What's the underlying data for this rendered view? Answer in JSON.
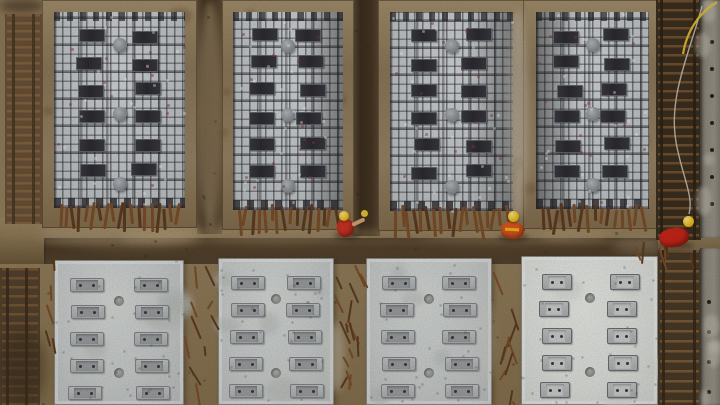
{
  "meta": {
    "description": "Aerial drone view of a precast concrete construction yard: four rebar formwork casting beds on top, four finished grey concrete slabs with embed plates below, rusty rebar ladders at the edges, and three workers wearing red/orange clothing and yellow hard hats standing in the trenches.",
    "width": 720,
    "height": 405
  },
  "palette": {
    "soil": "#97825f",
    "soil_dark": "#5e4a31",
    "soil_light": "#b6a083",
    "trench": "#3f3020",
    "frame": "#a08a68",
    "frame_rust": "#7a5737",
    "mat": "#c7ccce",
    "mat_grid": "#232328",
    "chair_plate": "#34333a",
    "slab": "#ccd0ce",
    "slab_bright": "#e4e6e2",
    "slab_plate": "#b9bcbd",
    "steel_dot": "#3a3a3a",
    "rust": "#7d4f2a",
    "rust_dark": "#5f3c22",
    "worker_red": "#cf3322",
    "worker_orange": "#e2561f",
    "hat_yellow": "#f2c41c",
    "skin": "#d8a478",
    "cable_pale": "#d6cfc0",
    "cable_yellow": "#e8c533",
    "wall": "#938d82"
  },
  "scene": {
    "mid_band": {
      "x": 0,
      "y": 218,
      "w": 720,
      "h": 46,
      "trench_x": 44,
      "trench_w": 614,
      "trench_y": 238,
      "trench_h": 26
    },
    "panels": [
      {
        "x": 42,
        "y": 0,
        "w": 155,
        "h": 228,
        "frame": 12,
        "dark_side": "none"
      },
      {
        "x": 222,
        "y": 0,
        "w": 132,
        "h": 230,
        "frame": 11,
        "dark_side": "right"
      },
      {
        "x": 378,
        "y": 0,
        "w": 147,
        "h": 231,
        "frame": 12,
        "dark_side": "right"
      },
      {
        "x": 523,
        "y": 0,
        "w": 139,
        "h": 229,
        "frame": 13,
        "dark_side": "left"
      }
    ],
    "panel_style": {
      "mat_top": 12,
      "mat_bottom": 20,
      "plate_w": 26,
      "plate_h": 13,
      "row_start": 18,
      "row_step": 27,
      "col_fracs": [
        0.28,
        0.7
      ],
      "circle_fracs": [
        0.17,
        0.52,
        0.88
      ],
      "circle_r": 7
    },
    "trenches": [
      {
        "x": 352,
        "y": 0,
        "w": 28,
        "h": 236
      },
      {
        "x": 197,
        "y": 0,
        "w": 25,
        "h": 234
      }
    ],
    "slabs": [
      {
        "x": 54,
        "y": 260,
        "w": 130,
        "h": 145,
        "bright": false
      },
      {
        "x": 218,
        "y": 258,
        "w": 116,
        "h": 147,
        "bright": false
      },
      {
        "x": 366,
        "y": 258,
        "w": 126,
        "h": 147,
        "bright": false
      },
      {
        "x": 521,
        "y": 256,
        "w": 137,
        "h": 149,
        "bright": true
      }
    ],
    "slab_style": {
      "plate_w": 34,
      "plate_h": 14,
      "bright_plate_w": 30,
      "bright_plate_h": 16,
      "row_start": 18,
      "row_step": 27,
      "rows": 5,
      "col_fracs": [
        0.25,
        0.75
      ],
      "hole_fracs": [
        0.28,
        0.78
      ],
      "hole_r": 5
    },
    "ladders": [
      {
        "name": "ladder-top-left",
        "x": 5,
        "y": 14,
        "w": 37,
        "h": 210,
        "gap": 8,
        "bg": "#6b5238",
        "rung": "#8a6742",
        "rail": "#4a3826",
        "rails": [
          7,
          27
        ]
      },
      {
        "name": "ladder-bottom-left",
        "x": 0,
        "y": 268,
        "w": 40,
        "h": 137,
        "gap": 9,
        "bg": "#55422c",
        "rung": "#7b5a36",
        "rail": "#3c2e1e",
        "rails": [
          6,
          25
        ]
      },
      {
        "name": "rebar-trench-top-right",
        "x": 656,
        "y": 0,
        "w": 45,
        "h": 240,
        "gap": 9,
        "bg": "#3b2f1f",
        "rung": "#7a5531",
        "rail": "#2c2315",
        "rails": [
          4,
          37
        ]
      },
      {
        "name": "rebar-trench-bottom-right",
        "x": 658,
        "y": 250,
        "w": 43,
        "h": 155,
        "gap": 10,
        "bg": "#4a3a26",
        "rung": "#83603a",
        "rail": "#35291a",
        "rails": [
          4,
          35
        ]
      }
    ],
    "walls": [
      {
        "name": "wall-top-right",
        "x": 700,
        "y": 0,
        "w": 20,
        "h": 238,
        "dots": {
          "x": 10,
          "y0": 40,
          "step": 27,
          "n": 7,
          "r": 2.2
        }
      },
      {
        "name": "wall-bottom-right",
        "x": 700,
        "y": 248,
        "w": 20,
        "h": 157,
        "dots": {
          "x": 7,
          "y0": 52,
          "step": 30,
          "n": 4,
          "r": 2.2
        }
      }
    ],
    "stick_areas": [
      {
        "x": 185,
        "y": 264,
        "w": 30,
        "h": 138,
        "n": 10
      },
      {
        "x": 335,
        "y": 262,
        "w": 29,
        "h": 141,
        "n": 16
      },
      {
        "x": 493,
        "y": 260,
        "w": 26,
        "h": 142,
        "n": 10
      },
      {
        "x": 42,
        "y": 250,
        "w": 12,
        "h": 110,
        "n": 5
      },
      {
        "x": 600,
        "y": 236,
        "w": 100,
        "h": 18,
        "n": 6
      }
    ],
    "patches_under": [
      {
        "x": 40,
        "y": 218,
        "w": 160,
        "h": 28,
        "c": "#b29c7b",
        "o": 0.55,
        "b": 6
      },
      {
        "x": 200,
        "y": 222,
        "w": 150,
        "h": 20,
        "c": "#a89070",
        "o": 0.5,
        "b": 6
      },
      {
        "x": 420,
        "y": 224,
        "w": 160,
        "h": 18,
        "c": "#a28a68",
        "o": 0.45,
        "b": 6
      },
      {
        "x": 44,
        "y": 0,
        "w": 14,
        "h": 230,
        "c": "#ab9573",
        "o": 0.5,
        "b": 5
      },
      {
        "x": 197,
        "y": 0,
        "w": 26,
        "h": 232,
        "c": "#a9946f",
        "o": 0.6,
        "b": 4
      },
      {
        "x": 0,
        "y": 230,
        "w": 720,
        "h": 8,
        "c": "#a58e6a",
        "o": 0.45,
        "b": 4
      },
      {
        "x": 612,
        "y": 238,
        "w": 60,
        "h": 16,
        "c": "#b3a183",
        "o": 0.4,
        "b": 5
      },
      {
        "x": 84,
        "y": 244,
        "w": 560,
        "h": 10,
        "c": "#6a5438",
        "o": 0.5,
        "b": 5
      },
      {
        "x": 0,
        "y": 0,
        "w": 44,
        "h": 12,
        "c": "#3a2c1c",
        "o": 0.6,
        "b": 4
      },
      {
        "x": 656,
        "y": 242,
        "w": 64,
        "h": 10,
        "c": "#8a7454",
        "o": 0.5,
        "b": 4
      },
      {
        "x": 122,
        "y": 230,
        "w": 80,
        "h": 14,
        "c": "#c3ad88",
        "o": 0.4,
        "b": 5
      },
      {
        "x": 540,
        "y": 228,
        "w": 70,
        "h": 14,
        "c": "#b9a37f",
        "o": 0.4,
        "b": 5
      }
    ],
    "patches_over": [
      {
        "x": 508,
        "y": 10,
        "w": 20,
        "h": 210,
        "c": "#cfc8ba",
        "o": 0.5,
        "b": 4
      },
      {
        "x": 0,
        "y": 330,
        "w": 46,
        "h": 75,
        "c": "#3c2e1d",
        "o": 0.55,
        "b": 7
      },
      {
        "x": 326,
        "y": 322,
        "w": 18,
        "h": 70,
        "c": "#d9d6cb",
        "o": 0.4,
        "b": 4
      },
      {
        "x": 480,
        "y": 300,
        "w": 14,
        "h": 80,
        "c": "#d5d2c7",
        "o": 0.35,
        "b": 4
      }
    ],
    "workers": [
      {
        "name": "worker-left",
        "x": 345,
        "y": 219,
        "body": {
          "w": 17,
          "h": 18,
          "c": "#cf3322",
          "rot": -12
        },
        "hat": {
          "dx": -1,
          "dy": -8,
          "r": 5
        },
        "arm": {
          "dx": 7,
          "dy": -4,
          "len": 14,
          "rot": -25
        },
        "tool": {
          "dx": 19,
          "dy": -9,
          "r": 3.5
        }
      },
      {
        "name": "worker-middle",
        "x": 512,
        "y": 222,
        "body": {
          "w": 23,
          "h": 17,
          "c": "#e2561f",
          "rot": 3
        },
        "hat": {
          "dx": 1,
          "dy": -11,
          "r": 5.5
        },
        "stripe": true
      },
      {
        "name": "worker-right",
        "x": 674,
        "y": 228,
        "body": {
          "w": 30,
          "h": 19,
          "c": "#cc2618",
          "rot": -8
        },
        "hat": {
          "dx": 14,
          "dy": -12,
          "r": 5.5
        }
      }
    ],
    "cable": {
      "pale": "M702,6 C690,52 668,96 676,142 C682,176 694,196 689,214",
      "yellow": "M717,2 C700,12 687,30 683,54"
    }
  }
}
